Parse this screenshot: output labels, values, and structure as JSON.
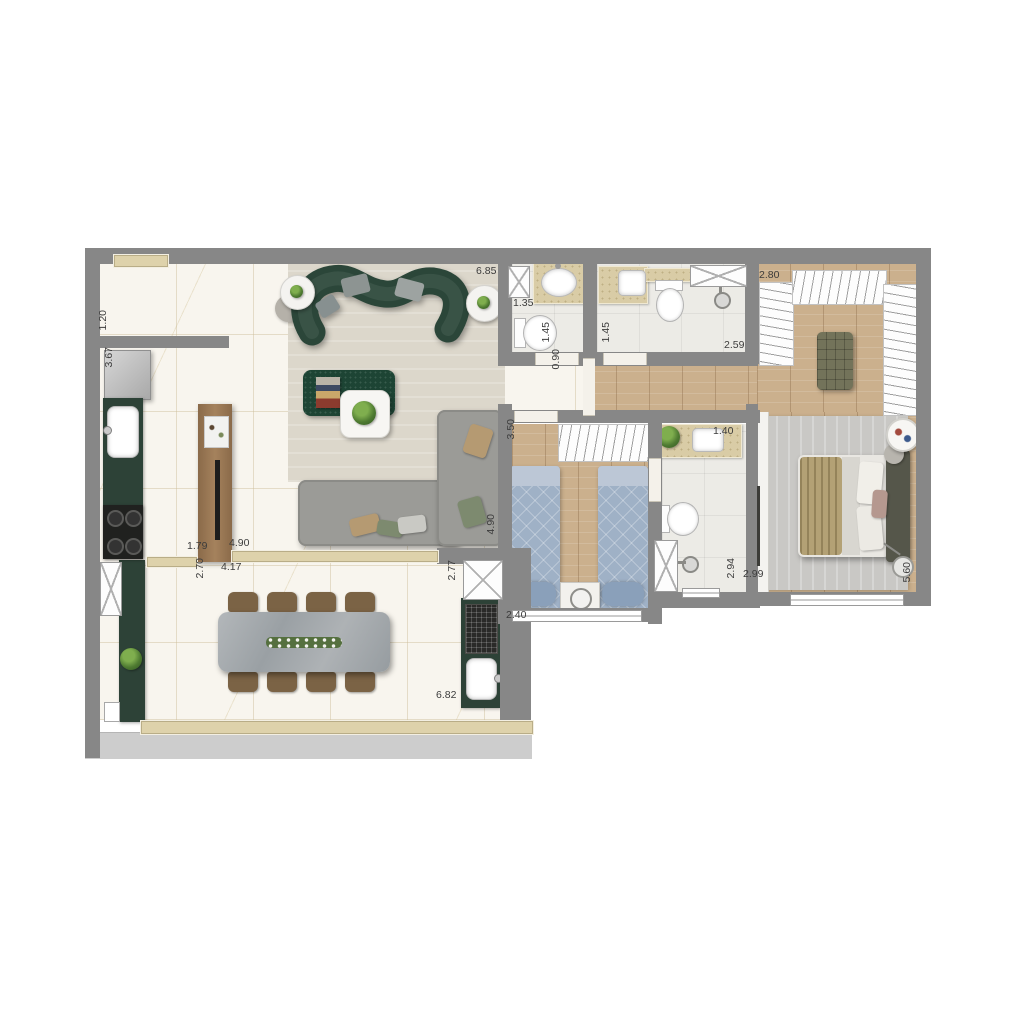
{
  "meta": {
    "type": "residential-floor-plan",
    "view": "top-down furnished apartment plan",
    "visible_text_kind": "dimension labels in meters"
  },
  "palette": {
    "wall_gray": "#878787",
    "marble_floor": "#f8f5ee",
    "wood_floor": "#cbb08d",
    "bath_tile": "#ecebe6",
    "dark_green_furniture": "#2d4237",
    "sofa_gray": "#9b9b97",
    "bed_blue": "#9fb1c6",
    "counter_beige": "#d9cca6",
    "living_rug": "#dcd7cb",
    "master_rug": "#c9c8c5",
    "dining_table_marble": "#a9adb0",
    "chair_brown": "#7b6345",
    "label_text": "#3c3c3c"
  },
  "dimensions": [
    {
      "value": "1.20",
      "x": 98,
      "y": 310,
      "vertical": true
    },
    {
      "value": "3.67",
      "x": 104,
      "y": 347,
      "vertical": true
    },
    {
      "value": "6.85",
      "x": 476,
      "y": 266,
      "vertical": false
    },
    {
      "value": "1.35",
      "x": 513,
      "y": 298,
      "vertical": false
    },
    {
      "value": "1.45",
      "x": 541,
      "y": 322,
      "vertical": true
    },
    {
      "value": "1.45",
      "x": 601,
      "y": 322,
      "vertical": true
    },
    {
      "value": "0.90",
      "x": 551,
      "y": 349,
      "vertical": true
    },
    {
      "value": "2.59",
      "x": 724,
      "y": 340,
      "vertical": false
    },
    {
      "value": "2.80",
      "x": 759,
      "y": 270,
      "vertical": false
    },
    {
      "value": "3.50",
      "x": 506,
      "y": 419,
      "vertical": true
    },
    {
      "value": "1.40",
      "x": 713,
      "y": 426,
      "vertical": false
    },
    {
      "value": "4.90",
      "x": 486,
      "y": 514,
      "vertical": true
    },
    {
      "value": "1.79",
      "x": 187,
      "y": 541,
      "vertical": false
    },
    {
      "value": "4.90",
      "x": 229,
      "y": 538,
      "vertical": false
    },
    {
      "value": "2.70",
      "x": 195,
      "y": 558,
      "vertical": true
    },
    {
      "value": "4.17",
      "x": 221,
      "y": 562,
      "vertical": false
    },
    {
      "value": "2.77",
      "x": 447,
      "y": 560,
      "vertical": true
    },
    {
      "value": "2.40",
      "x": 506,
      "y": 610,
      "vertical": false
    },
    {
      "value": "6.82",
      "x": 436,
      "y": 690,
      "vertical": false
    },
    {
      "value": "2.94",
      "x": 726,
      "y": 558,
      "vertical": true
    },
    {
      "value": "2.99",
      "x": 743,
      "y": 569,
      "vertical": false
    },
    {
      "value": "5.60",
      "x": 902,
      "y": 562,
      "vertical": true
    }
  ],
  "rooms": [
    {
      "name": "kitchen",
      "furniture": [
        "refrigerator",
        "counter-sink",
        "cooktop",
        "pantry-cabinet",
        "plant",
        "service-shaft",
        "service-window"
      ]
    },
    {
      "name": "living-room",
      "furniture": [
        "curved-green-sofa",
        "l-shaped-gray-sofa",
        "green-marble-coffee-table",
        "white-coffee-table",
        "round-side-table-left",
        "round-side-table-right",
        "pouf",
        "plants",
        "area-rug",
        "tv-panel"
      ]
    },
    {
      "name": "dining-terrace",
      "furniture": [
        "stone-dining-table",
        "flower-centerpiece",
        "dining-chairs",
        "grill-counter",
        "charcoal-grill",
        "terrace-sink",
        "terrace-shaft",
        "railing-window"
      ]
    },
    {
      "name": "powder-room",
      "furniture": [
        "oval-washbasin",
        "toilet",
        "shaft"
      ]
    },
    {
      "name": "bathroom",
      "furniture": [
        "washbasin-counter",
        "toilet",
        "shower-head",
        "shower-tray"
      ]
    },
    {
      "name": "hallway",
      "furniture": []
    },
    {
      "name": "twin-bedroom",
      "furniture": [
        "open-wardrobe-hangers",
        "single-bed-left",
        "single-bed-right",
        "nightstand",
        "table-lamp",
        "window"
      ]
    },
    {
      "name": "suite-bathroom",
      "furniture": [
        "washbasin-counter",
        "plant",
        "toilet",
        "shower-head",
        "shaft"
      ]
    },
    {
      "name": "walk-in-closet",
      "furniture": [
        "hanging-rack-left",
        "hanging-rack-top",
        "hanging-rack-right",
        "tufted-ottoman"
      ]
    },
    {
      "name": "master-bedroom",
      "furniture": [
        "double-bed",
        "headboard",
        "wardrobe",
        "round-tray-table",
        "pouf",
        "floor-lamp",
        "area-rug",
        "window"
      ]
    }
  ],
  "counts": {
    "dining_chairs": 8,
    "twin_beds": 2,
    "closet_racks": 3,
    "cooktop_burners": 4,
    "bathrooms": 3
  }
}
